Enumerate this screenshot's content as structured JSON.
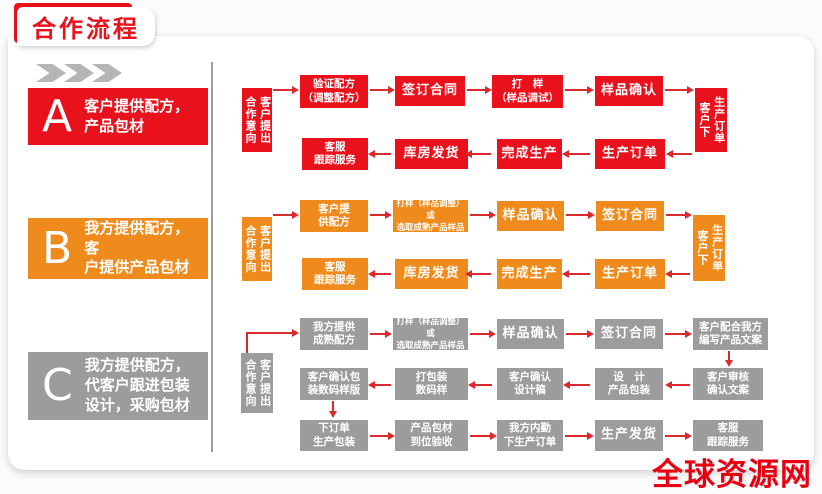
{
  "page": {
    "title": "合作流程",
    "watermark": "全球资源网"
  },
  "colors": {
    "red": "#e8111c",
    "orange": "#ef8b1d",
    "gray": "#9c9c9c",
    "arrow": "#d92a2e"
  },
  "labels": {
    "intent_left": "合作意向",
    "intent_right": "客户提出",
    "order_left": "客户下",
    "order_right": "生产订单"
  },
  "sections": {
    "a": {
      "letter": "A",
      "desc": "客户提供配方，\n产品包材",
      "row1": [
        "验证配方\n（调整配方）",
        "签订合同",
        "打　样\n（样品调试）",
        "样品确认"
      ],
      "row2": [
        "客服\n跟踪服务",
        "库房发货",
        "完成生产",
        "生产订单"
      ]
    },
    "b": {
      "letter": "B",
      "desc": "我方提供配方，客\n户提供产品包材",
      "row1": [
        "客户提\n供配方",
        "打样（样品调整）或\n选取成熟产品样品",
        "样品确认",
        "签订合同"
      ],
      "row2": [
        "客服\n跟踪服务",
        "库房发货",
        "完成生产",
        "生产订单"
      ]
    },
    "c": {
      "letter": "C",
      "desc": "我方提供配方，\n代客户跟进包装\n设计，采购包材",
      "row1": [
        "我方提供\n成熟配方",
        "打样（样品调整）或\n选取成熟产品样品",
        "样品确认",
        "签订合同",
        "客户配合我方\n编写产品文案"
      ],
      "row2": [
        "客户确认包\n装数码样版",
        "打包装\n数码样",
        "客户确认\n设计稿",
        "设　计\n产品包装",
        "客户审核\n确认文案"
      ],
      "row3": [
        "下订单\n生产包装",
        "产品包材\n到位验收",
        "我方内勤\n下生产订单",
        "生产发货",
        "客服\n跟踪服务"
      ]
    }
  }
}
